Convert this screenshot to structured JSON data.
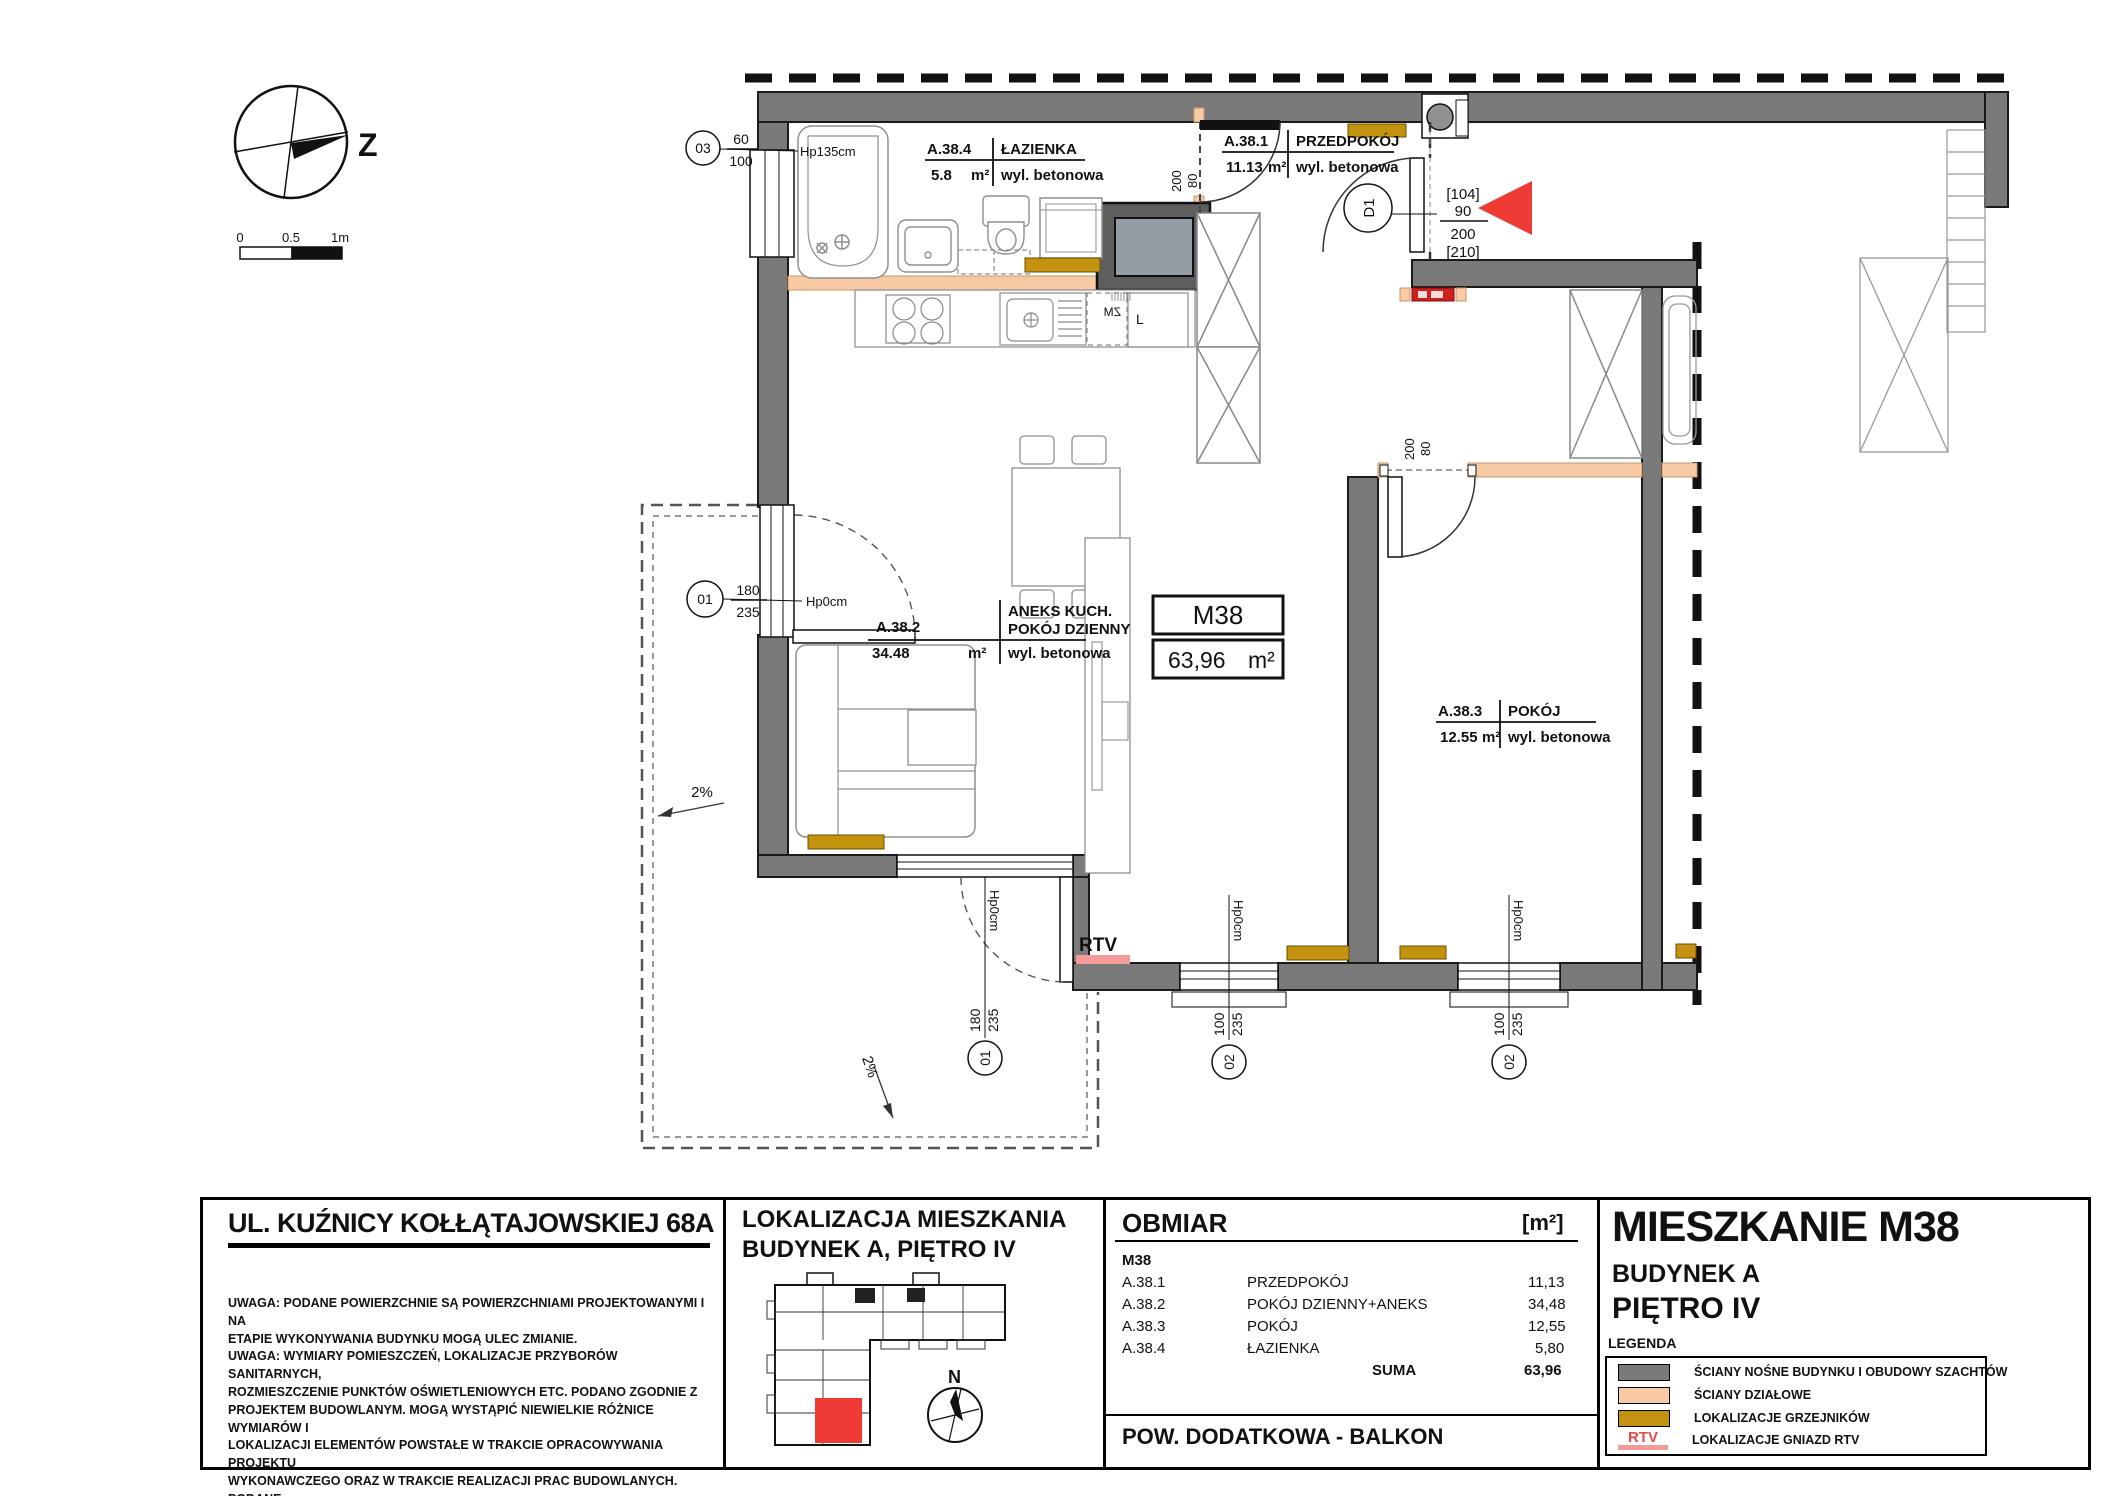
{
  "compass": {
    "north": "Z"
  },
  "scale": {
    "t0": "0",
    "t1": "0.5",
    "t2": "1m"
  },
  "unit_box": {
    "id": "M38",
    "area": "63,96",
    "unit": "m²"
  },
  "rooms": [
    {
      "code": "A.38.4",
      "name": "ŁAZIENKA",
      "area": "5.8",
      "unit": "m²",
      "floor": "wyl. betonowa"
    },
    {
      "code": "A.38.1",
      "name": "PRZEDPOKÓJ",
      "area": "11.13",
      "unit": "m²",
      "floor": "wyl. betonowa"
    },
    {
      "code": "A.38.2",
      "name1": "ANEKS KUCH.",
      "name2": "POKÓJ DZIENNY",
      "area": "34.48",
      "unit": "m²",
      "floor": "wyl. betonowa"
    },
    {
      "code": "A.38.3",
      "name": "POKÓJ",
      "area": "12.55",
      "unit": "m²",
      "floor": "wyl. betonowa"
    }
  ],
  "openings": {
    "w03": {
      "id": "03",
      "a": "60",
      "b": "100",
      "hp": "Hp135cm"
    },
    "o01l": {
      "id": "01",
      "a": "180",
      "b": "235",
      "hp": "Hp0cm"
    },
    "o01b": {
      "id": "01",
      "a": "180",
      "b": "235",
      "hp": "Hp0cm"
    },
    "o02a": {
      "id": "02",
      "a": "100",
      "b": "235",
      "hp": "Hp0cm"
    },
    "o02b": {
      "id": "02",
      "a": "100",
      "b": "235",
      "hp": "Hp0cm"
    },
    "d1": {
      "id": "D1",
      "l1": "[104]",
      "l2": "90",
      "l3": "200",
      "l4": "[210]"
    },
    "door_bath": {
      "h": "200",
      "w": "80"
    },
    "door_room": {
      "h": "200",
      "w": "80"
    }
  },
  "annotations": {
    "rtv": "RTV",
    "slope1": "2%",
    "slope2": "2%",
    "dishwasher": "ZM",
    "fridge": "L"
  },
  "footer": {
    "address": {
      "title": "UL. KUŹNICY KOŁŁĄTAJOWSKIEJ 68A",
      "notes": [
        "UWAGA: PODANE POWIERZCHNIE SĄ POWIERZCHNIAMI PROJEKTOWANYMI I NA",
        "ETAPIE WYKONYWANIA BUDYNKU MOGĄ ULEC ZMIANIE.",
        "UWAGA: WYMIARY POMIESZCZEŃ, LOKALIZACJE PRZYBORÓW SANITARNYCH,",
        "ROZMIESZCZENIE PUNKTÓW OŚWIETLENIOWYCH ETC. PODANO ZGODNIE Z",
        "PROJEKTEM BUDOWLANYM. MOGĄ WYSTĄPIĆ NIEWIELKIE RÓŻNICE WYMIARÓW I",
        "LOKALIZACJI ELEMENTÓW POWSTAŁE W TRAKCIE OPRACOWYWANIA PROJEKTU",
        "WYKONAWCZEGO ORAZ W TRAKCIE REALIZACJI PRAC BUDOWLANYCH. PODANE",
        "WYMIARY SĄ WYMIARAMI W ŚWIETLE PIONOWYCH PRZEGRÓD (ŚCIAN) W STANIE",
        "WYKOŃCZONYM."
      ]
    },
    "location": {
      "title1": "LOKALIZACJA MIESZKANIA",
      "title2": "BUDYNEK A, PIĘTRO IV",
      "north": "N"
    },
    "obmiar": {
      "title": "OBMIAR",
      "unit_header": "[m²]",
      "apartment": "M38",
      "rows": [
        {
          "code": "A.38.1",
          "name": "PRZEDPOKÓJ",
          "area": "11,13"
        },
        {
          "code": "A.38.2",
          "name": "POKÓJ DZIENNY+ANEKS",
          "area": "34,48"
        },
        {
          "code": "A.38.3",
          "name": "POKÓJ",
          "area": "12,55"
        },
        {
          "code": "A.38.4",
          "name": "ŁAZIENKA",
          "area": "5,80"
        }
      ],
      "sum_label": "SUMA",
      "sum": "63,96",
      "additional": "POW. DODATKOWA - BALKON"
    },
    "title_block": {
      "title": "MIESZKANIE M38",
      "building_label": "BUDYNEK",
      "building": "A",
      "floor": "PIĘTRO IV",
      "legend_title": "LEGENDA",
      "legend": [
        {
          "label": "ŚCIANY NOŚNE BUDYNKU I OBUDOWY SZACHTÓW",
          "color": "#7a7a7a"
        },
        {
          "label": "ŚCIANY DZIAŁOWE",
          "color": "#F8CBA4"
        },
        {
          "label": "LOKALIZACJE GRZEJNIKÓW",
          "color": "#C3920E"
        },
        {
          "label": "LOKALIZACJE GNIAZD RTV",
          "color": "#E94946",
          "tag": "RTV"
        }
      ]
    }
  }
}
